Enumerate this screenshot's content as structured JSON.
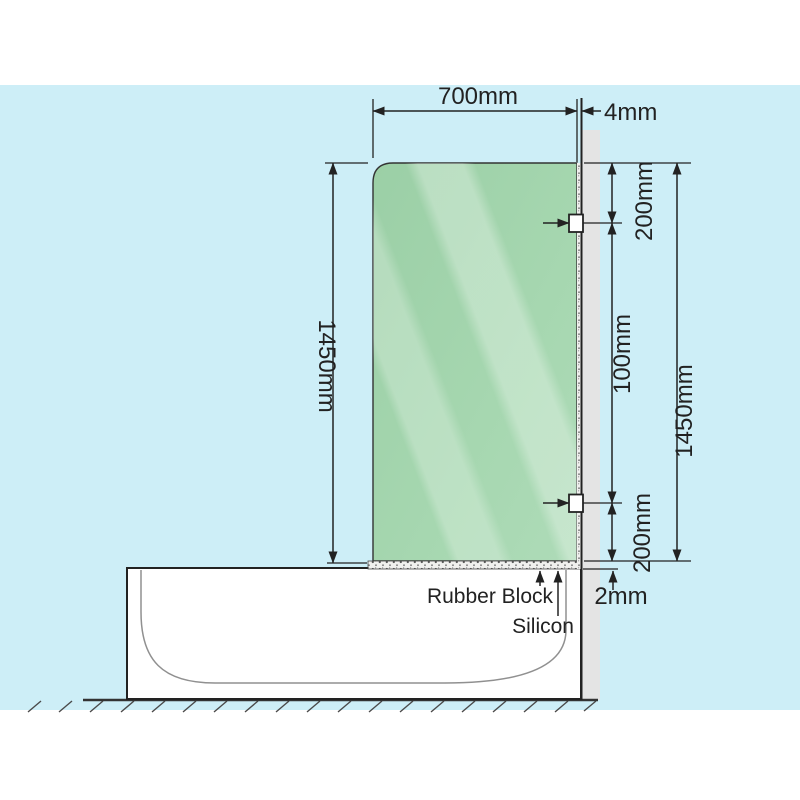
{
  "diagram": {
    "title": "Shower screen over bath installation diagram",
    "dims": {
      "width": "700mm",
      "thickness": "4mm",
      "height_left": "1450mm",
      "top_offset": "200mm",
      "middle_span": "100mm",
      "bottom_offset": "200mm",
      "height_right": "1450mm",
      "base_gap": "2mm"
    },
    "labels": {
      "rubber_block": "Rubber Block",
      "silicon": "Silicon"
    },
    "colors": {
      "background_band": "#cdeef7",
      "glass_green": "#a3d5ae",
      "glass_highlight": "#c8e8cf",
      "wall_gray": "#e4e4e4",
      "line_dark": "#222222",
      "tub_inner_line": "#909090",
      "silicon_speckle_bg": "#f0f0ee"
    }
  }
}
